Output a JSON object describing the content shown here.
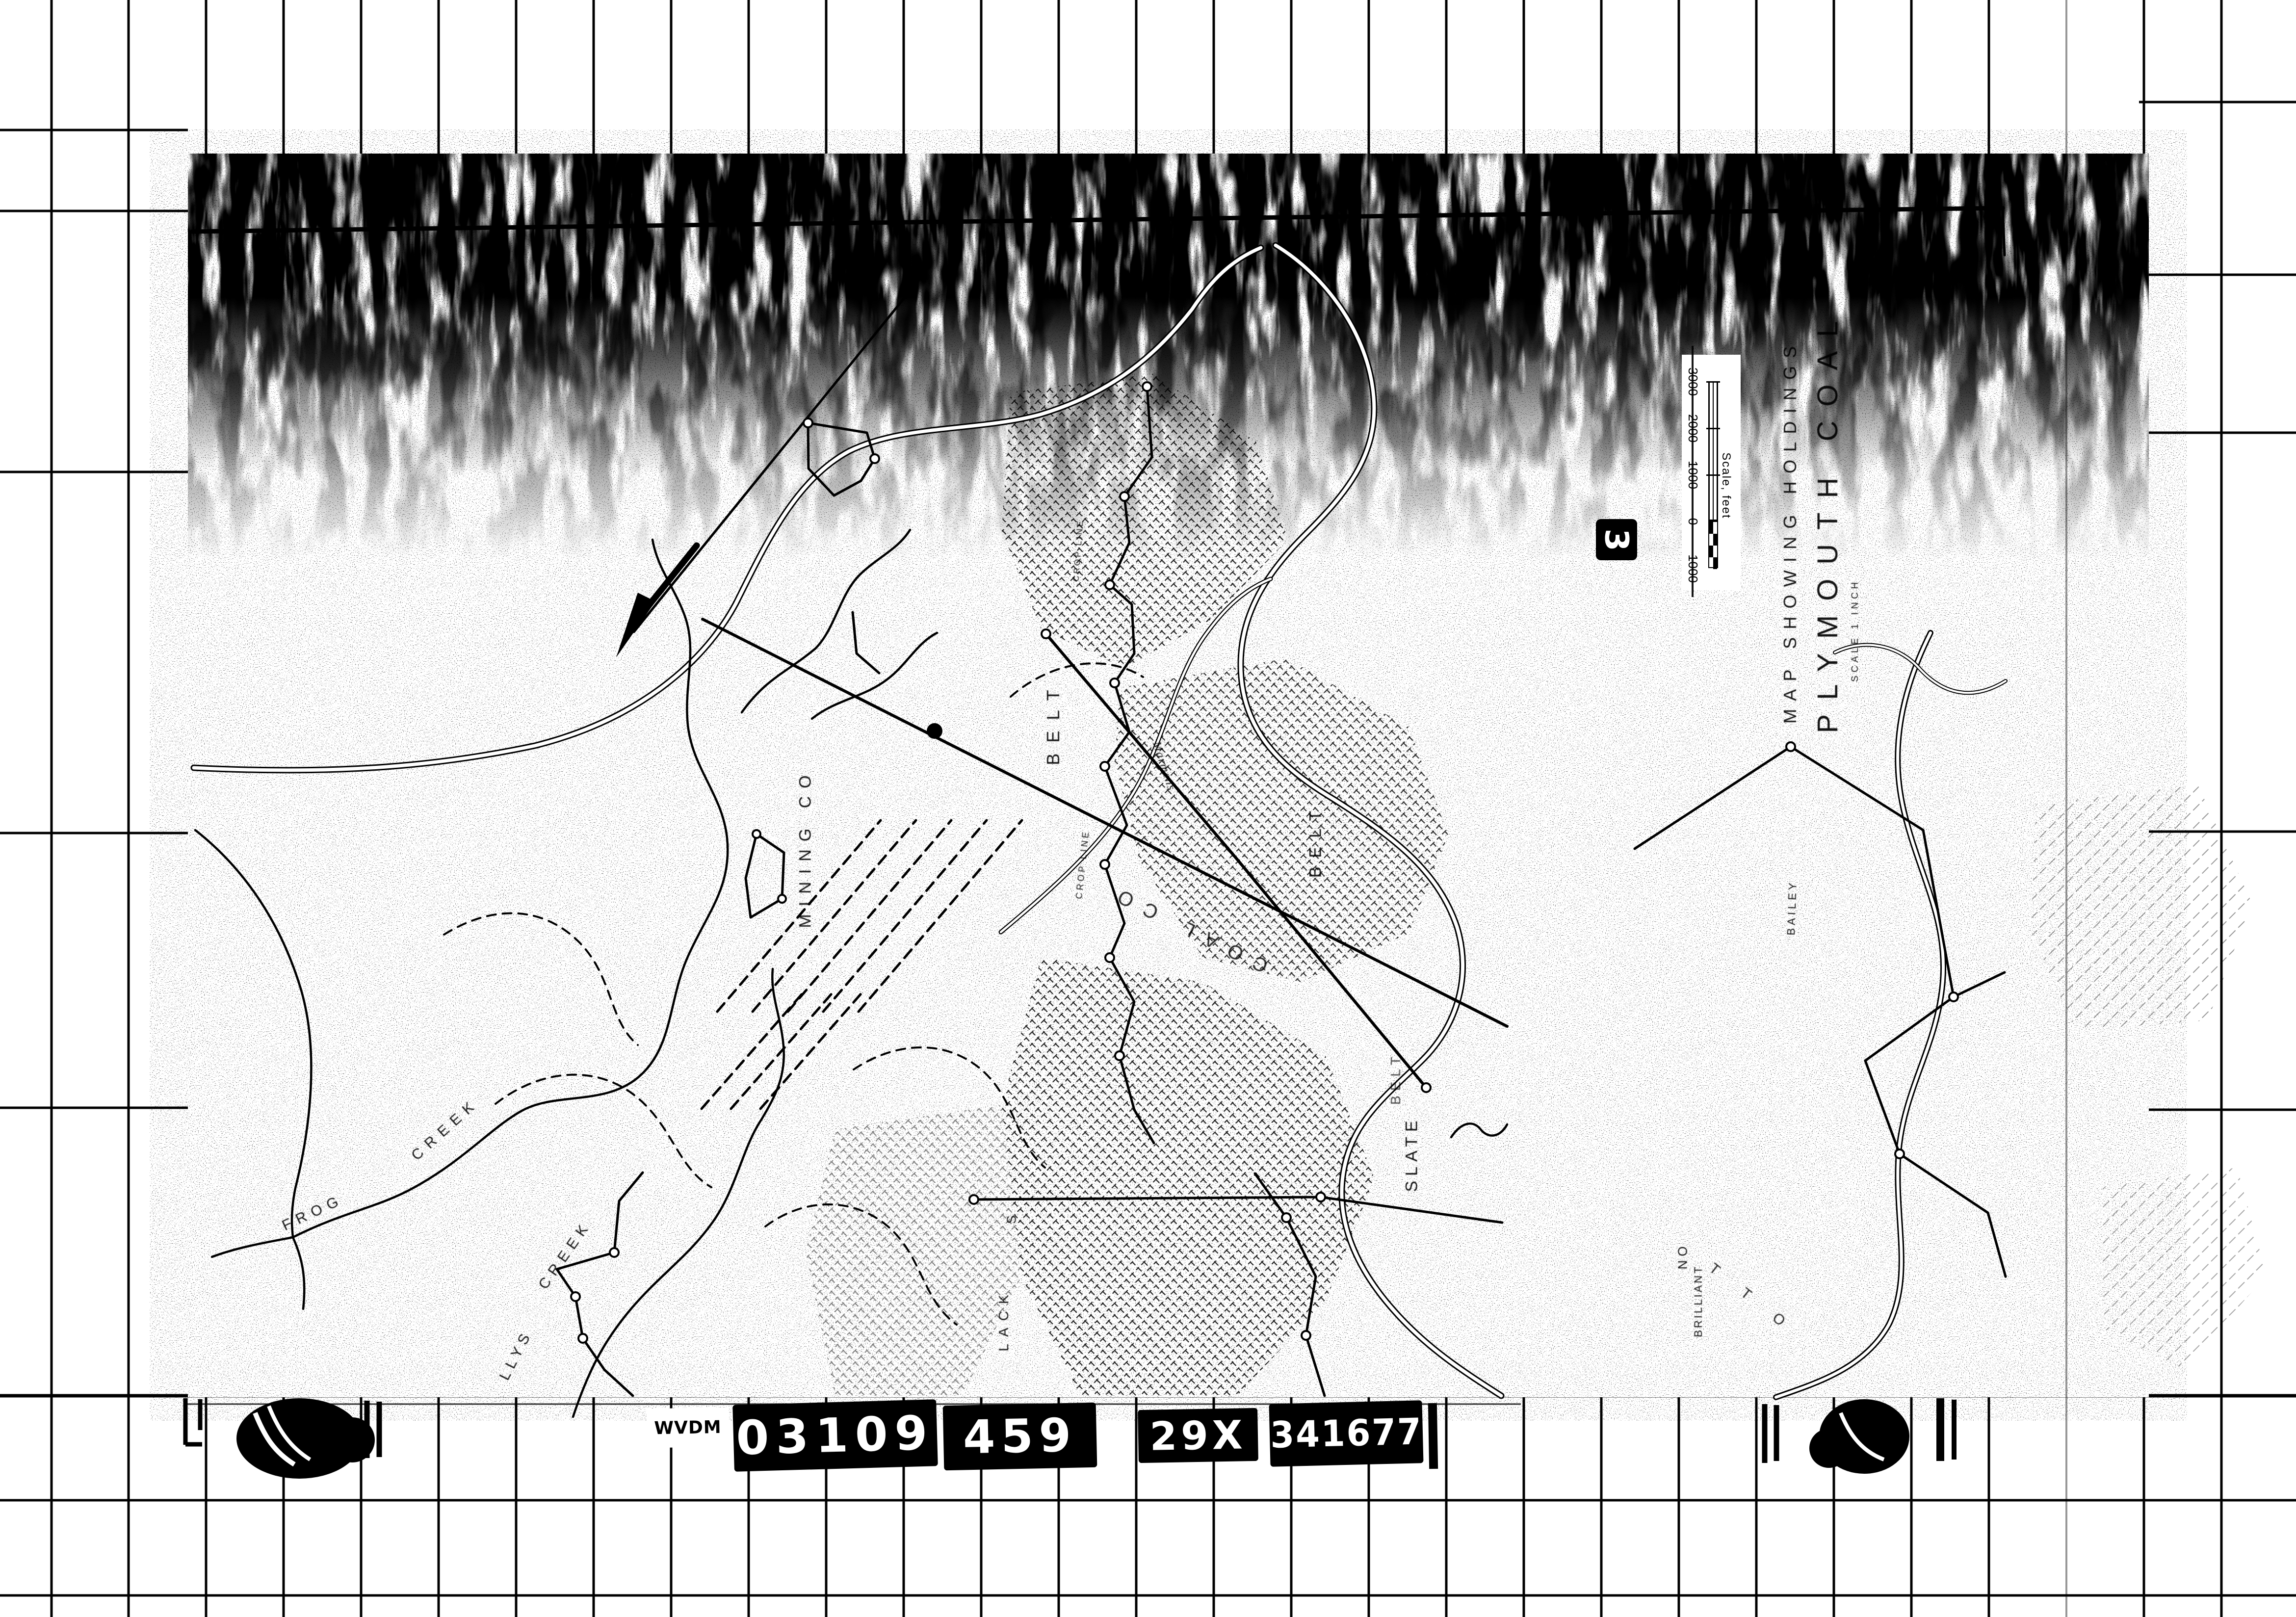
{
  "film_strip": {
    "prefix": "WVDM",
    "blocks": [
      "03109",
      "459",
      "29X",
      "341677"
    ]
  },
  "frame_badge": {
    "number": "3"
  },
  "title_block": {
    "line1": "MAP SHOWING HOLDINGS",
    "line2": "PLYMOUTH COAL",
    "line3": "SCALE 1 INCH"
  },
  "scale_bar": {
    "caption": "Scale, feet",
    "ticks": [
      "3000",
      "2000",
      "1000",
      "0",
      "1000"
    ]
  },
  "map_labels": {
    "frog": "FROG",
    "frog_creek": "CREEK",
    "llys": "LLYS",
    "llys_creek": "CREEK",
    "mining_co": "MINING CO",
    "belt_a": "BELT",
    "belt_b": "BELT",
    "belt_c": "BELT",
    "slate": "SLATE",
    "coal_co": "COAL CO",
    "marmens": "Marmens",
    "crop_line_a": "CROP LINE",
    "crop_line_b": "CROP LINE",
    "lack": "LACK",
    "lack_s": "S",
    "bailey": "BAILEY",
    "brilliant": "BRILLIANT",
    "no_mark": "NO",
    "tto": "T T O"
  },
  "colors": {
    "ink": "#000000",
    "paper": "#ffffff"
  }
}
